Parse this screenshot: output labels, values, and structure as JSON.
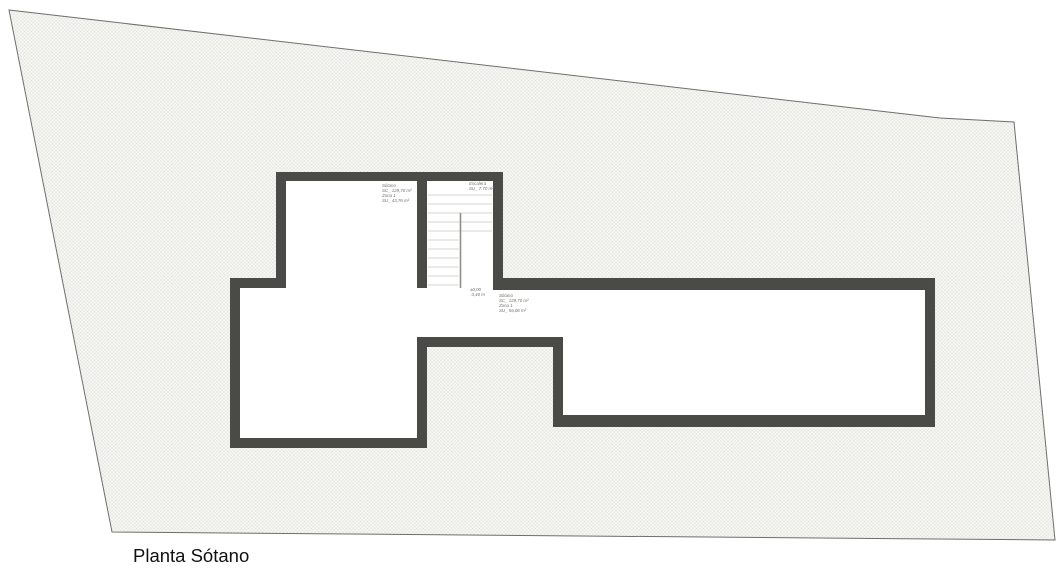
{
  "title": "Planta Sótano",
  "colors": {
    "wall": "#4a4a46",
    "site_fill": "#f7f7f4",
    "hatch_line": "#d0d0cc",
    "site_outline": "#6e6e6e",
    "label_text": "#73736e",
    "title_text": "#111111"
  },
  "labels": {
    "room_upper": [
      "Sótano",
      "SC_ 129,70 m²",
      "Zona 1",
      "SU_ 43,76 m²"
    ],
    "stair": [
      "Escalera",
      "SU_ 7,70 m²"
    ],
    "level_marker": [
      "±0,00",
      "-3,40 m"
    ],
    "room_lower": [
      "Sótano",
      "SC_ 129,70 m²",
      "Zona 1",
      "SU_ 56,06 m²"
    ]
  }
}
